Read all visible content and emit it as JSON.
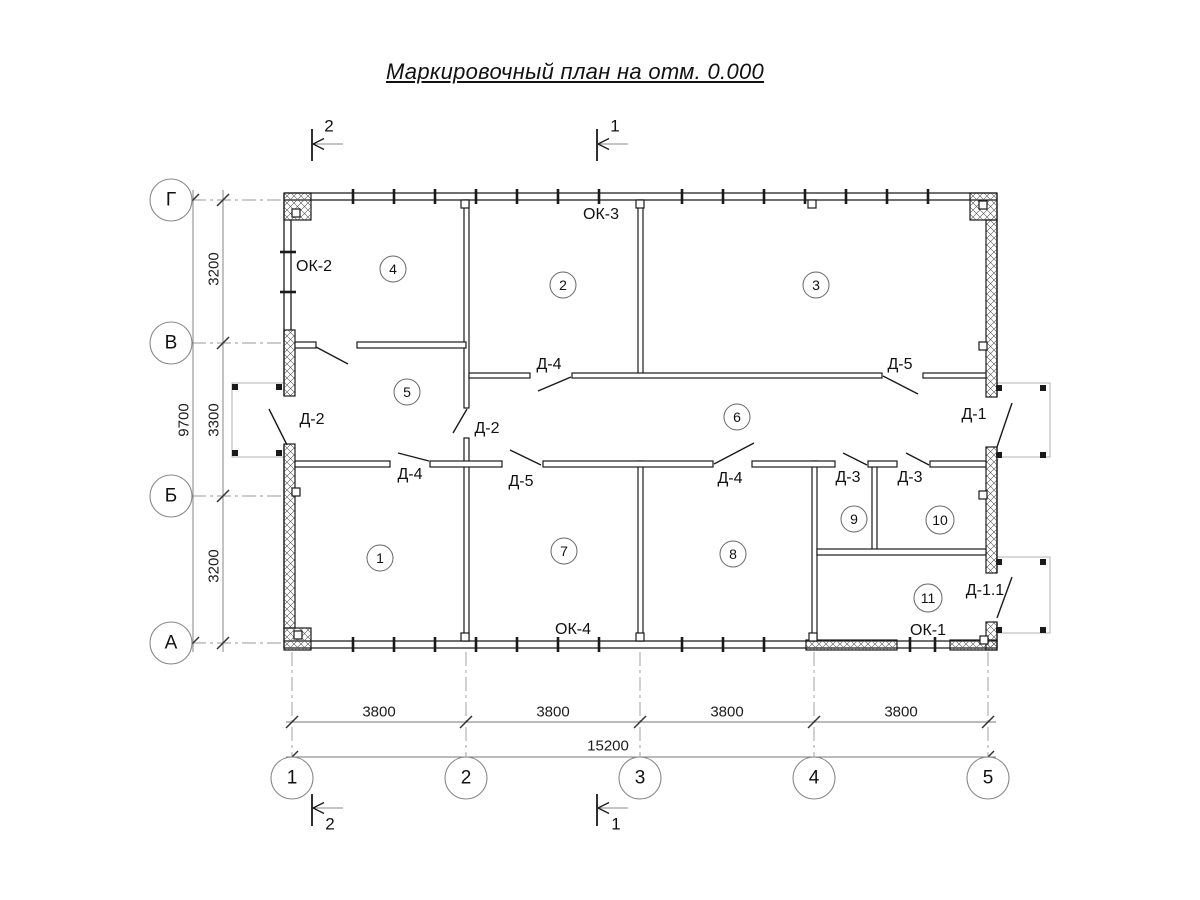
{
  "title": "Маркировочный план на отм. 0.000",
  "grid": {
    "rows": [
      "Г",
      "В",
      "Б",
      "А"
    ],
    "cols": [
      "1",
      "2",
      "3",
      "4",
      "5"
    ]
  },
  "dimensions": {
    "vertical_segments": [
      "3200",
      "3300",
      "3200"
    ],
    "vertical_total": "9700",
    "horizontal_segments": [
      "3800",
      "3800",
      "3800",
      "3800"
    ],
    "horizontal_total": "15200"
  },
  "sections": {
    "s1": "1",
    "s2": "2"
  },
  "rooms": [
    "1",
    "2",
    "3",
    "4",
    "5",
    "6",
    "7",
    "8",
    "9",
    "10",
    "11"
  ],
  "marks": {
    "windows": {
      "ok1": "ОК-1",
      "ok2": "ОК-2",
      "ok3": "ОК-3",
      "ok4": "ОК-4"
    },
    "doors": {
      "d1": "Д-1",
      "d1_1": "Д-1.1",
      "d2": "Д-2",
      "d3": "Д-3",
      "d4": "Д-4",
      "d5": "Д-5"
    }
  }
}
